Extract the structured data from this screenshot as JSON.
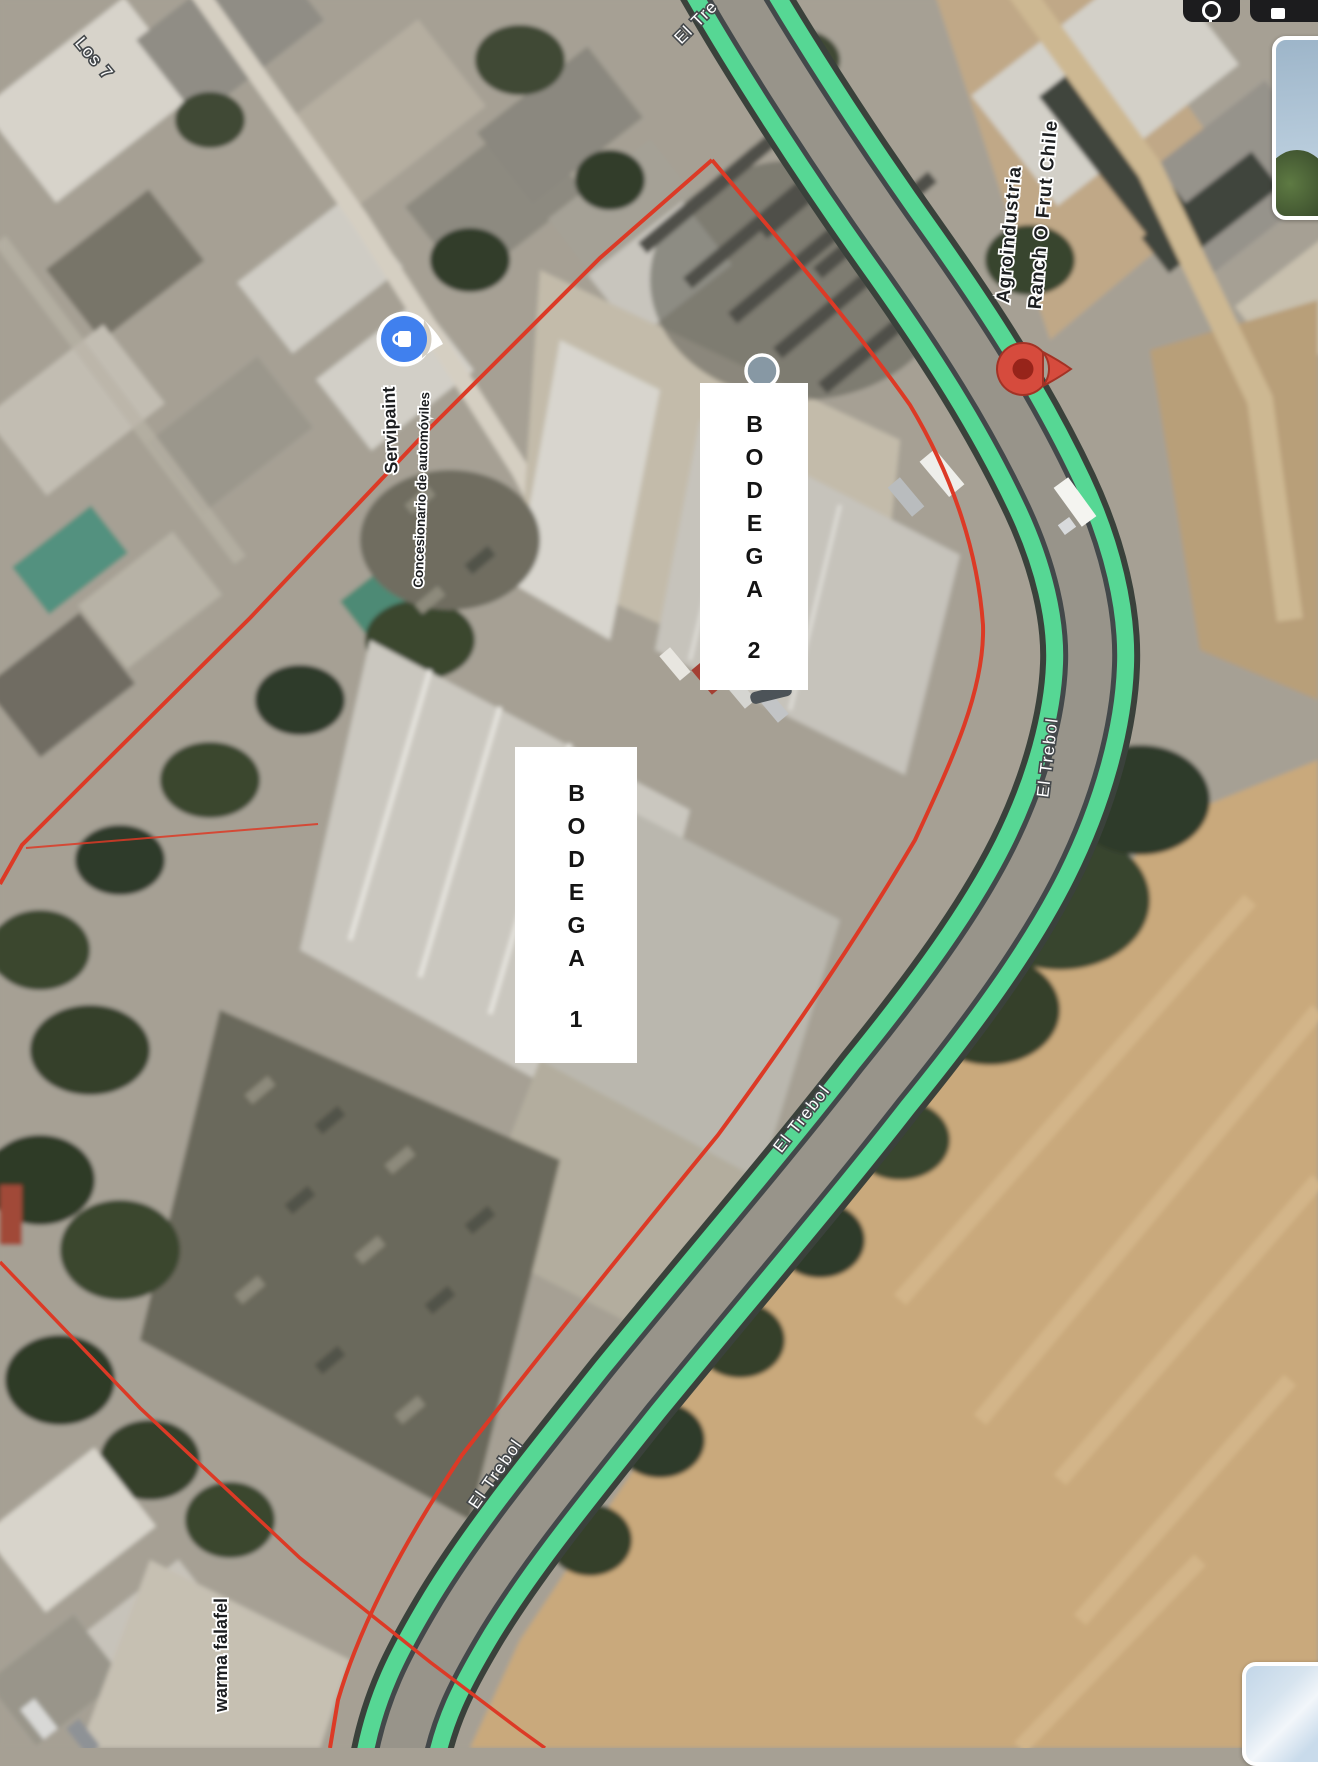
{
  "street_labels": {
    "top_left": "Los 7",
    "top": "El Tre",
    "el_trebol": "El Trebol"
  },
  "pois": {
    "servipaint": {
      "name": "Servipaint",
      "category": "Concesionario de automóviles"
    },
    "agroindustria": {
      "name_line1": "Agroindustria",
      "name_line2": "Ranch O Frut Chile"
    },
    "shawarma": {
      "name": "warma falafel"
    }
  },
  "annotations": {
    "bodega2": {
      "word": "BODEGA",
      "number": "2"
    },
    "bodega1": {
      "word": "BODEGA",
      "number": "1"
    }
  },
  "colors": {
    "route_green": "#56d794",
    "route_casing": "#3a413b",
    "boundary_red": "#dc3a26",
    "pin_red": "#d64b3d",
    "pin_red_dark": "#97241a",
    "pin_blue": "#4080ee",
    "poi_gray": "#8798a4"
  }
}
